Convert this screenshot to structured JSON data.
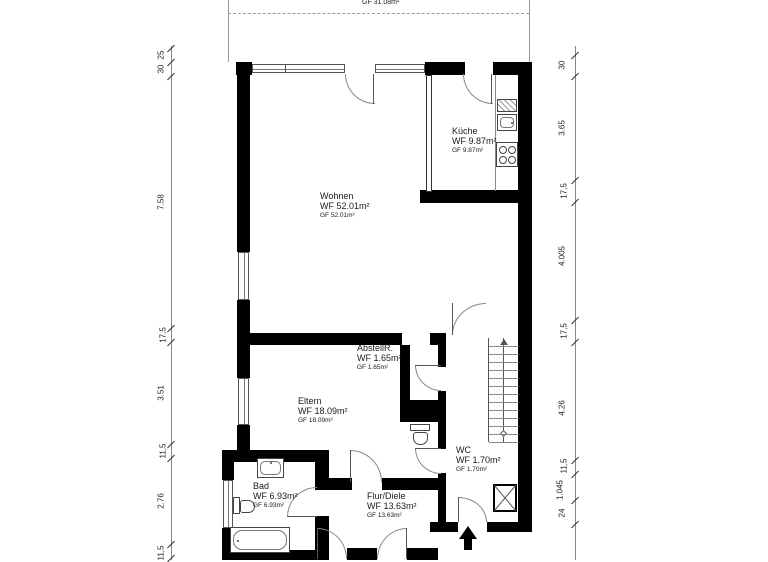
{
  "plan": {
    "terrace": {
      "gf": "GF 31.08m²"
    },
    "rooms": {
      "kueche": {
        "name": "Küche",
        "wf": "WF 9.87m²",
        "gf": "GF 9.87m²"
      },
      "wohnen": {
        "name": "Wohnen",
        "wf": "WF 52.01m²",
        "gf": "GF 52.01m²"
      },
      "abstellr": {
        "name": "AbstellR.",
        "wf": "WF 1.65m²",
        "gf": "GF 1.65m²"
      },
      "eltern": {
        "name": "Eltern",
        "wf": "WF 18.09m²",
        "gf": "GF 18.09m²"
      },
      "wc": {
        "name": "WC",
        "wf": "WF 1.70m²",
        "gf": "GF 1.70m²"
      },
      "bad": {
        "name": "Bad",
        "wf": "WF 6.93m²",
        "gf": "GF 6.93m²"
      },
      "flur": {
        "name": "Flur/Diele",
        "wf": "WF 13.63m²",
        "gf": "GF 13.63m²"
      }
    },
    "dimensions": {
      "left": [
        "25",
        "30",
        "7.58",
        "17,5",
        "3.51",
        "11,5",
        "2.76",
        "11,5"
      ],
      "right": [
        "30",
        "3.65",
        "17,5",
        "4.005",
        "17,5",
        "4.26",
        "11,5",
        "1.045",
        "24"
      ]
    },
    "colors": {
      "wall": "#000000",
      "line": "#666666",
      "text": "#1a1a1a",
      "background": "#ffffff"
    }
  }
}
